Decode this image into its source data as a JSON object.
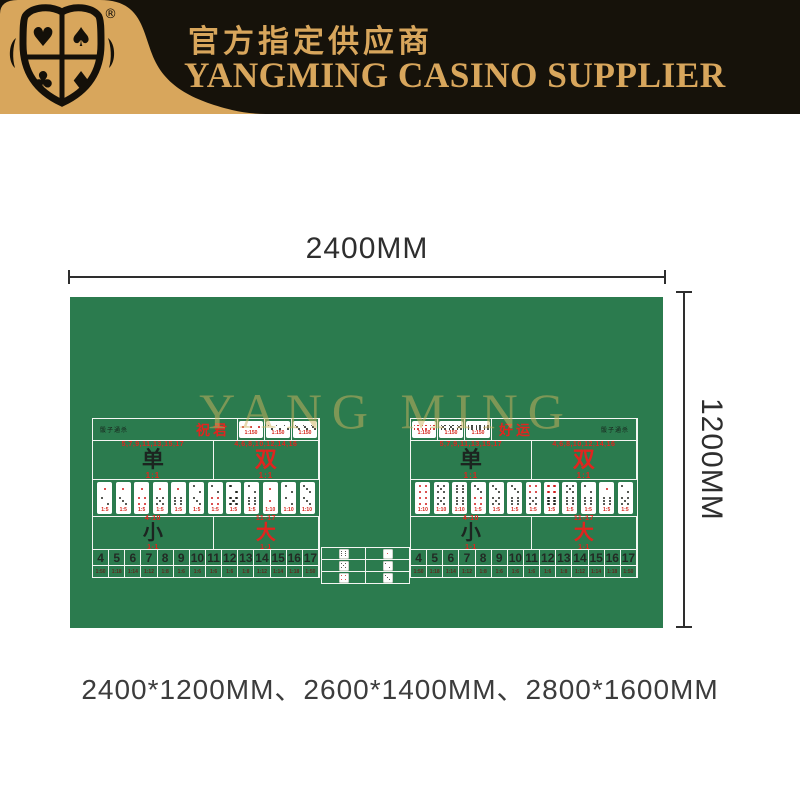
{
  "header": {
    "title_cn": "官方指定供应商",
    "title_en": "YANGMING CASINO SUPPLIER",
    "trademark": "®",
    "colors": {
      "gold": "#D8A65C",
      "background": "#16120A"
    }
  },
  "dimension_labels": {
    "top": "2400MM",
    "right": "1200MM"
  },
  "sizes_caption": "2400*1200MM、2600*1400MM、2800*1600MM",
  "felt": {
    "color": "#2B7B4E",
    "watermark": "YANG MING",
    "shared": {
      "odd": {
        "numbers": "5,7,9,11,13,15,17",
        "char": "单",
        "odds": "1:1"
      },
      "even": {
        "numbers": "4,6,8,10,12,14,16",
        "char": "双",
        "odds": "1:1"
      },
      "small": {
        "range": "4-10",
        "char": "小",
        "odds": "1-1"
      },
      "big": {
        "range": "11-17",
        "char": "大",
        "odds": "1-1"
      },
      "totals": {
        "numbers": [
          "4",
          "5",
          "6",
          "7",
          "8",
          "9",
          "10",
          "11",
          "12",
          "13",
          "14",
          "15",
          "16",
          "17"
        ],
        "odds": [
          "1:50",
          "1:18",
          "1:14",
          "1:12",
          "1:8",
          "1:6",
          "1:6",
          "1:6",
          "1:6",
          "1:8",
          "1:12",
          "1:14",
          "1:18",
          "1:50"
        ]
      },
      "singles_grid": [
        [
          6,
          1
        ],
        [
          5,
          2
        ],
        [
          4,
          3
        ]
      ]
    },
    "halves": [
      {
        "side": "left",
        "luck": "祝君",
        "kill": "骰子通杀",
        "top_order": "text_first",
        "triples": [
          {
            "die": 1,
            "odds": "1:150"
          },
          {
            "die": 2,
            "odds": "1:150"
          },
          {
            "die": 3,
            "odds": "1:150"
          }
        ],
        "pairs": [
          {
            "dice": [
              1,
              2
            ],
            "odds": "1:5"
          },
          {
            "dice": [
              1,
              3
            ],
            "odds": "1:5"
          },
          {
            "dice": [
              1,
              4
            ],
            "odds": "1:5"
          },
          {
            "dice": [
              1,
              5
            ],
            "odds": "1:5"
          },
          {
            "dice": [
              1,
              6
            ],
            "odds": "1:5"
          },
          {
            "dice": [
              2,
              3
            ],
            "odds": "1:5"
          },
          {
            "dice": [
              2,
              4
            ],
            "odds": "1:5"
          },
          {
            "dice": [
              2,
              5
            ],
            "odds": "1:5"
          },
          {
            "dice": [
              2,
              6
            ],
            "odds": "1:5"
          },
          {
            "dice": [
              1,
              1
            ],
            "odds": "1:10"
          },
          {
            "dice": [
              2,
              2
            ],
            "odds": "1:10"
          },
          {
            "dice": [
              3,
              3
            ],
            "odds": "1:10"
          }
        ]
      },
      {
        "side": "right",
        "luck": "好运",
        "kill": "骰子通杀",
        "top_order": "dice_first",
        "triples": [
          {
            "die": 4,
            "odds": "1:150"
          },
          {
            "die": 5,
            "odds": "1:150"
          },
          {
            "die": 6,
            "odds": "1:150"
          }
        ],
        "pairs": [
          {
            "dice": [
              4,
              4
            ],
            "odds": "1:10"
          },
          {
            "dice": [
              5,
              5
            ],
            "odds": "1:10"
          },
          {
            "dice": [
              6,
              6
            ],
            "odds": "1:10"
          },
          {
            "dice": [
              3,
              4
            ],
            "odds": "1:5"
          },
          {
            "dice": [
              3,
              5
            ],
            "odds": "1:5"
          },
          {
            "dice": [
              3,
              6
            ],
            "odds": "1:5"
          },
          {
            "dice": [
              4,
              5
            ],
            "odds": "1:5"
          },
          {
            "dice": [
              4,
              6
            ],
            "odds": "1:5"
          },
          {
            "dice": [
              5,
              6
            ],
            "odds": "1:5"
          },
          {
            "dice": [
              2,
              6
            ],
            "odds": "1:5"
          },
          {
            "dice": [
              1,
              6
            ],
            "odds": "1:5"
          },
          {
            "dice": [
              2,
              5
            ],
            "odds": "1:5"
          }
        ]
      }
    ]
  }
}
